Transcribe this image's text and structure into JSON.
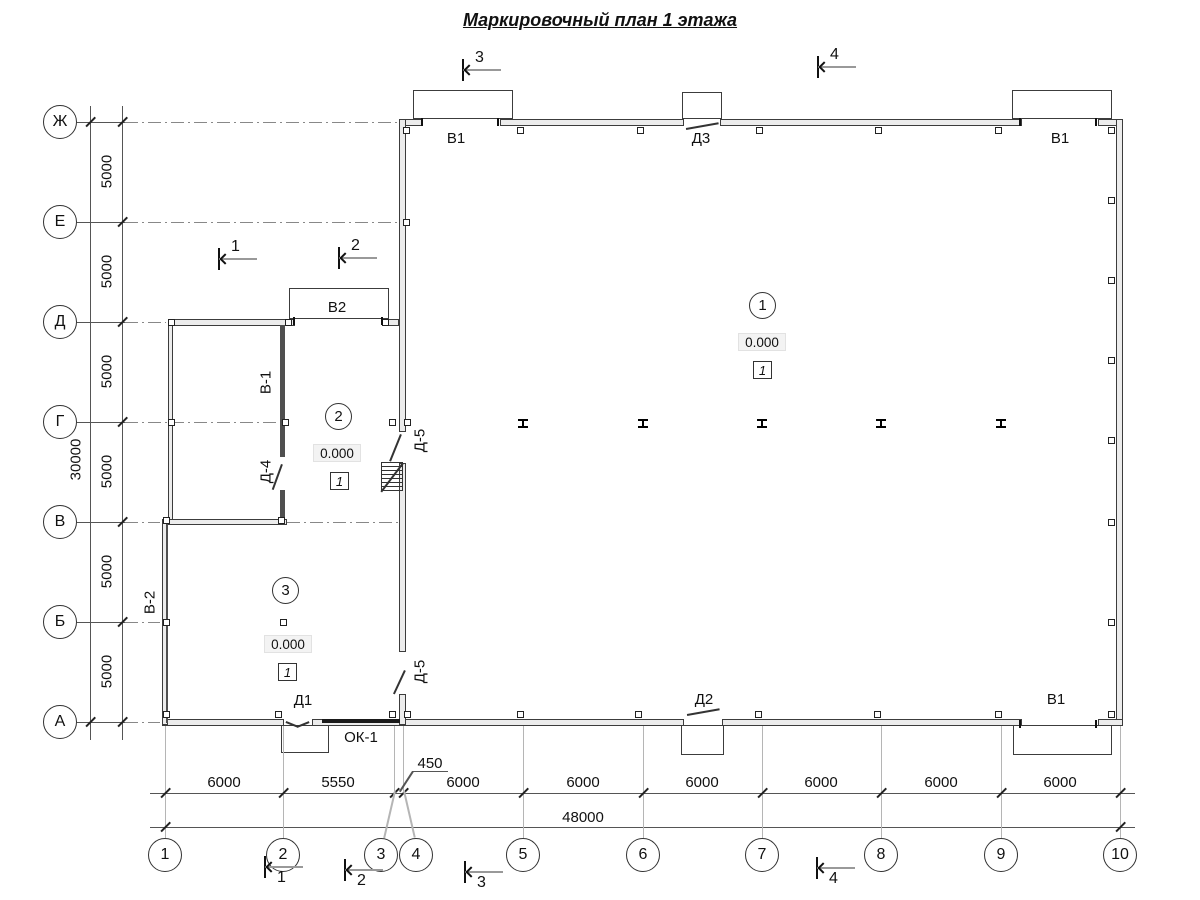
{
  "title": "Маркировочный план 1 этажа",
  "grid": {
    "row_labels": [
      "Ж",
      "Е",
      "Д",
      "Г",
      "В",
      "Б",
      "А"
    ],
    "col_labels": [
      "1",
      "2",
      "3",
      "4",
      "5",
      "6",
      "7",
      "8",
      "9",
      "10"
    ]
  },
  "dims": {
    "row_spacing": [
      "5000",
      "5000",
      "5000",
      "5000",
      "5000",
      "5000"
    ],
    "row_total": "30000",
    "col_spacing": [
      "6000",
      "5550",
      "6000",
      "6000",
      "6000",
      "6000",
      "6000",
      "6000"
    ],
    "col_offset_34": "450",
    "col_total": "48000"
  },
  "sections": [
    "1",
    "2",
    "3",
    "4"
  ],
  "rooms": [
    {
      "number": "1",
      "elevation": "0.000",
      "finish_type": "1"
    },
    {
      "number": "2",
      "elevation": "0.000",
      "finish_type": "1"
    },
    {
      "number": "3",
      "elevation": "0.000",
      "finish_type": "1"
    }
  ],
  "marks": {
    "gate_top_left": "В1",
    "door_top_mid": "Д3",
    "gate_top_right": "В1",
    "gate_annex": "В2",
    "window_annex_inner": "В-1",
    "window_annex_left": "В-2",
    "door_annex": "Д-4",
    "door_inner_upper": "Д-5",
    "door_inner_lower": "Д-5",
    "door_bottom_left": "Д1",
    "window_bottom": "ОК-1",
    "door_bottom_mid": "Д2",
    "gate_bottom_right": "В1"
  }
}
